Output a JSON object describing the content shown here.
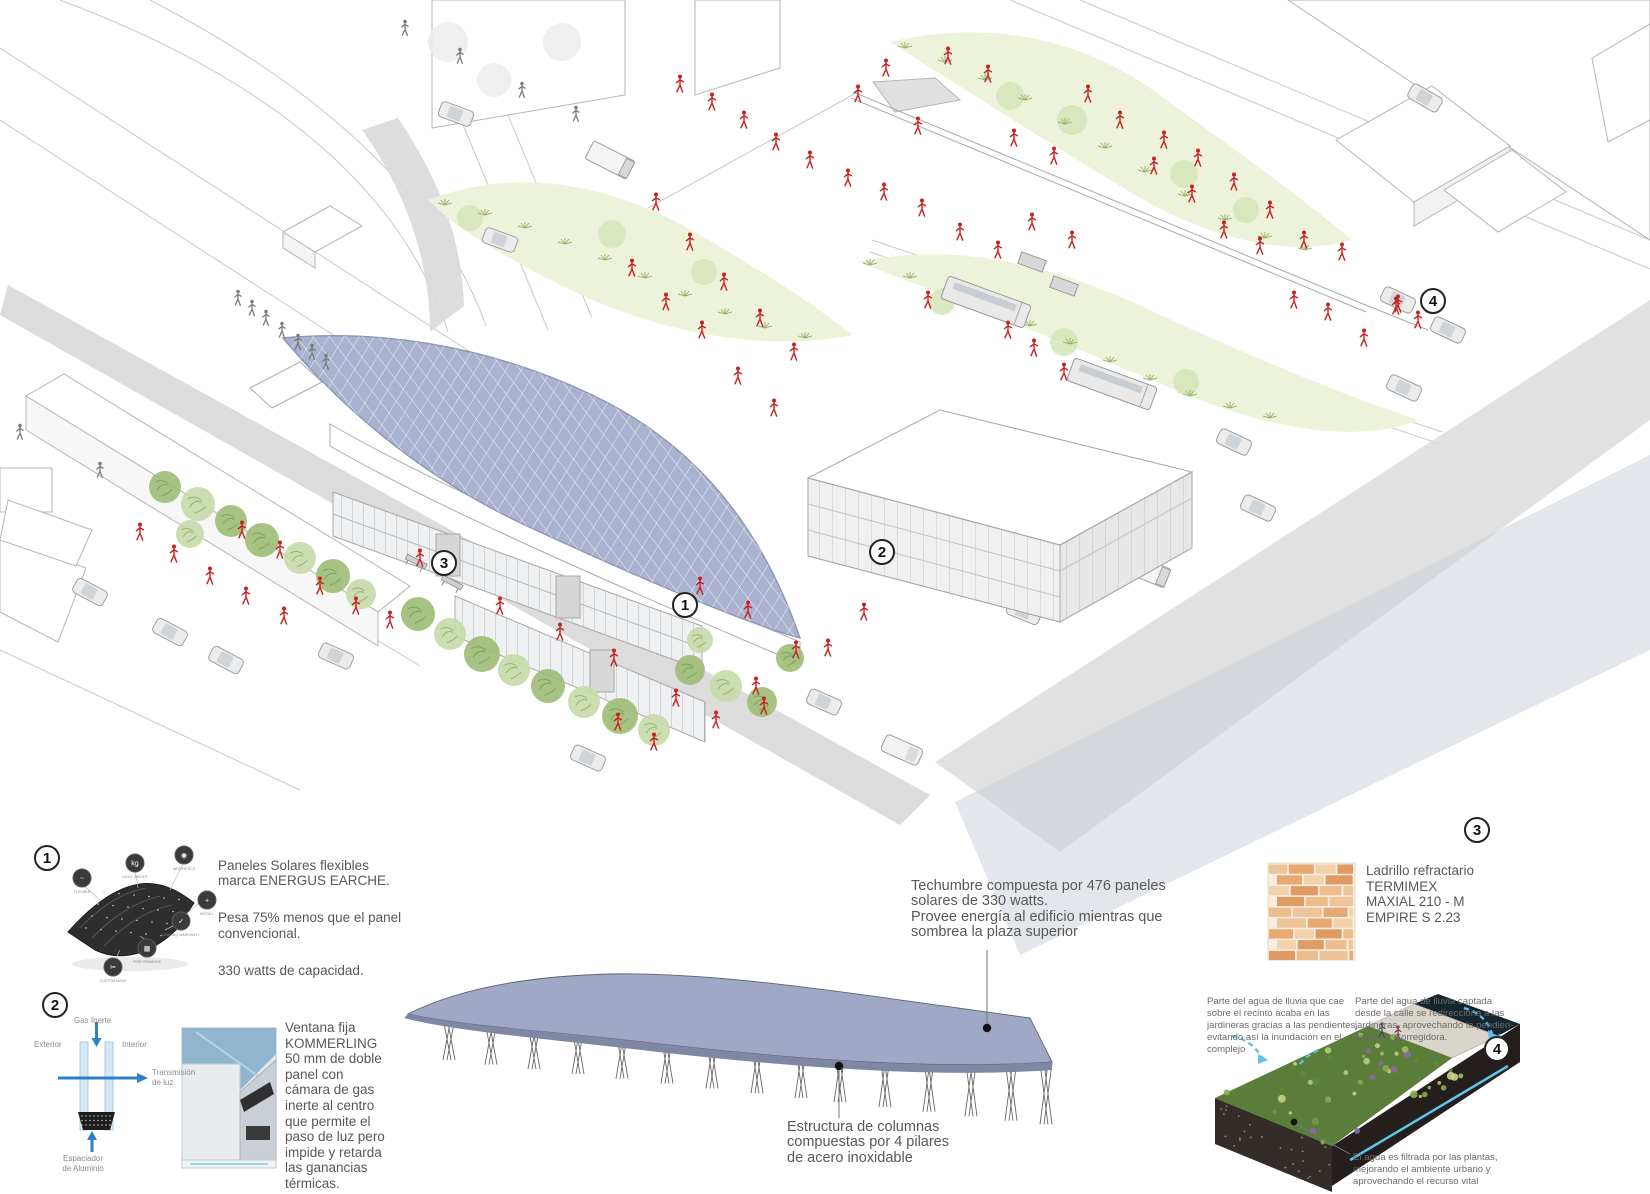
{
  "colors": {
    "solar_roof": "#a9b2ce",
    "canopy": "#9fa9c5",
    "green_area": "#edf3da",
    "plant_green": "#a3bd7a",
    "figure_red": "#c92323",
    "street_gray": "#d8d8d8",
    "arrow_blue": "#2f7fc1",
    "water_cyan": "#5fc0e8",
    "brick_orange": "#e2a470",
    "text_gray": "#58585a"
  },
  "scene": {
    "marker1": "1",
    "marker2": "2",
    "marker3": "3",
    "marker4": "4"
  },
  "canopy_note": {
    "text": "Techumbre compuesta por 476 paneles\nsolares de 330 watts.\nProvee energía al edificio mientras que\nsombrea la plaza superior"
  },
  "columns_note": {
    "text": "Estructura de columnas\ncompuestas por 4 pilares\nde acero inoxidable"
  },
  "callout1": {
    "num": "1",
    "p1": "Paneles Solares flexibles\nmarca ENERGUS EARCHE.",
    "p2": "Pesa 75% menos que el panel\nconvencional.",
    "p3": "330 watts de capacidad.",
    "icons": [
      {
        "label": "FLEXIBLE",
        "glyph": "~"
      },
      {
        "label": "LIGHT WEIGHT",
        "glyph": "kg"
      },
      {
        "label": "AESTHETICS",
        "glyph": "◉"
      },
      {
        "label": "INSTALL",
        "glyph": "+"
      },
      {
        "label": "LEADING WARRANTY",
        "glyph": "✓"
      },
      {
        "label": "PERFORMANCE",
        "glyph": "▦"
      },
      {
        "label": "CUSTOM MADE",
        "glyph": "✂"
      }
    ]
  },
  "callout2": {
    "num": "2",
    "body": "Ventana fija\nKOMMERLING\n50 mm de doble\npanel con\ncámara de gas\ninerte al centro\nque permite el\npaso de luz pero\nimpide y retarda\nlas ganancias\ntérmicas.",
    "labels": {
      "gas": "Gas Inerte",
      "exterior": "Exterior",
      "interior": "Interior",
      "transmision": "Transmisión\nde luz",
      "espaciador": "Espaciador\nde Aluminio"
    }
  },
  "callout3": {
    "num": "3",
    "body": "Ladrillo refractario\nTERMIMEX\nMAXIAL 210 - M\nEMPIRE S 2.23"
  },
  "callout4": {
    "num": "4",
    "para_left": "Parte del agua de lluvia que cae\nsobre el recinto acaba en las\njardineras gracias a las pendientes,\nevitando así la inundación en el\ncomplejo",
    "para_right": "Parte del agua de lluvia captada\ndesde la calle se redirecciona a las\njardineras, aprovechando la pendien-\nte de Av. Corregidora.",
    "para_bottom": "El agua es filtrada por las plantas,\nmejorando el ambiente urbano y\naprovechando el recurso vital"
  }
}
